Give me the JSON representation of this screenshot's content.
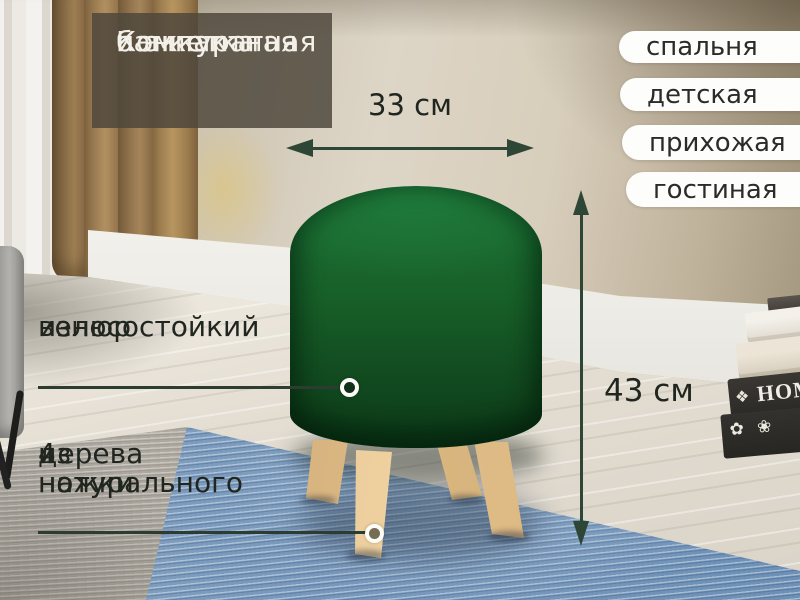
{
  "title": {
    "line1": "Компактная",
    "line2": "и аккуратная",
    "line3": "банкетка"
  },
  "room_tags": {
    "items": [
      {
        "label": "спальня"
      },
      {
        "label": "детская"
      },
      {
        "label": "прихожая"
      },
      {
        "label": "гостиная"
      }
    ]
  },
  "dimensions": {
    "width_label": "33 см",
    "height_label": "43 см"
  },
  "features": {
    "velour": {
      "line1": "износостойкий",
      "line2": "велюр"
    },
    "legs": {
      "line1": "4 ножки",
      "line2": "из натурального",
      "line3": "дерева"
    }
  },
  "props": {
    "book_spine_text": "HOME",
    "book_ornament": "❖",
    "book_flowers": "✿ ❀"
  },
  "colors": {
    "ottoman_green": "#17602c",
    "wood_leg": "#e3c08d",
    "arrow_dark_green": "#2e4636",
    "tag_background": "#fdfdfc",
    "title_overlay": "rgba(79,72,60,0.85)",
    "title_text": "#f3f0e9",
    "label_text": "#20261f",
    "rug_blue": "#7697bb",
    "rug_grey": "#b3aea5",
    "wall_beige": "#d5ccba"
  }
}
